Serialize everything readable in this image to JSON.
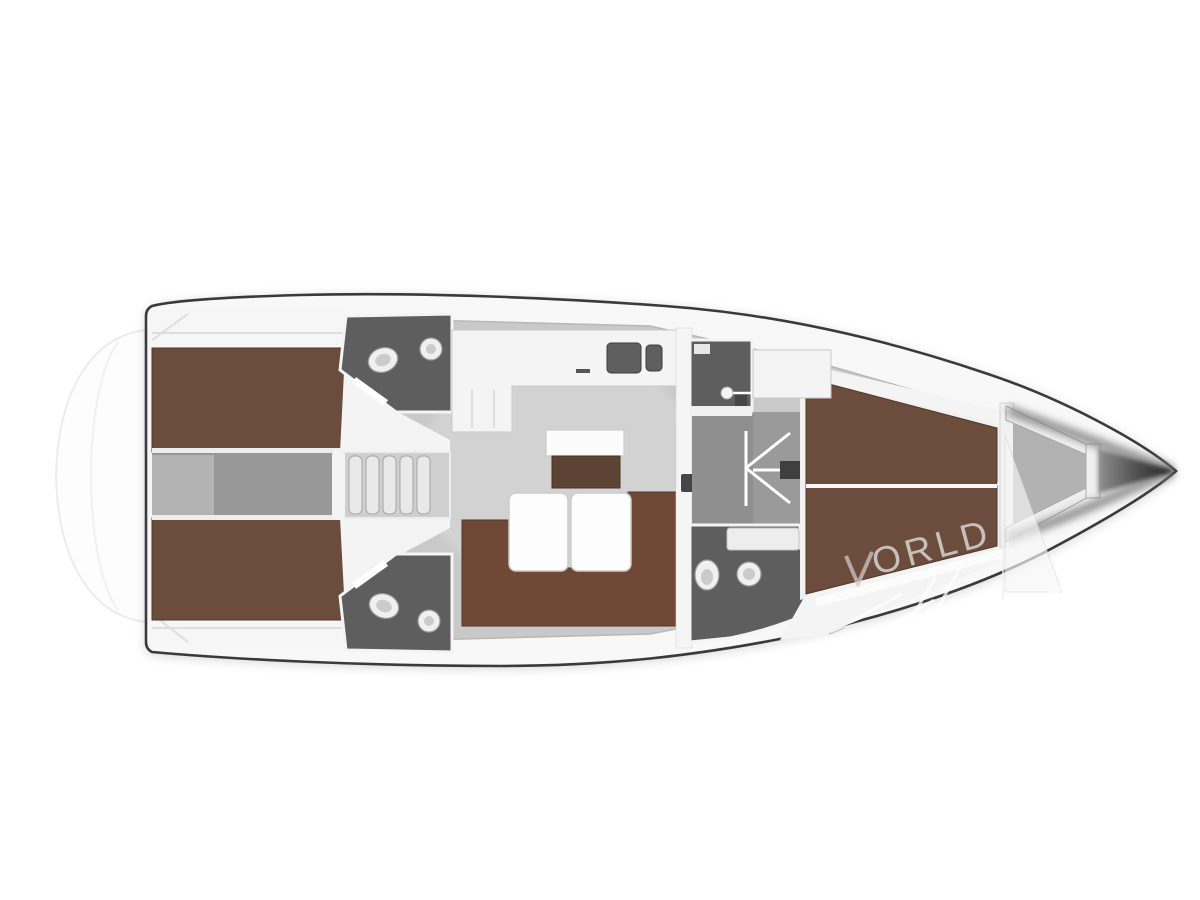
{
  "watermark": {
    "text": "ORLD"
  },
  "palette": {
    "hull_outline": "#3a3a3a",
    "deck_white": "#f8f8f8",
    "floor_gray": "#c9c9c9",
    "corridor_gray": "#989898",
    "entry_gray": "#8f8f8f",
    "dark_room": "#5e5e5e",
    "wood_brown": "#6b4c3d",
    "sofa_brown": "#6f4936",
    "cabinet_brown": "#5d4334",
    "fixture_white": "#f0f0f0",
    "wall_white": "#f4f4f4",
    "watermark_gray": "#cfc9c4"
  }
}
